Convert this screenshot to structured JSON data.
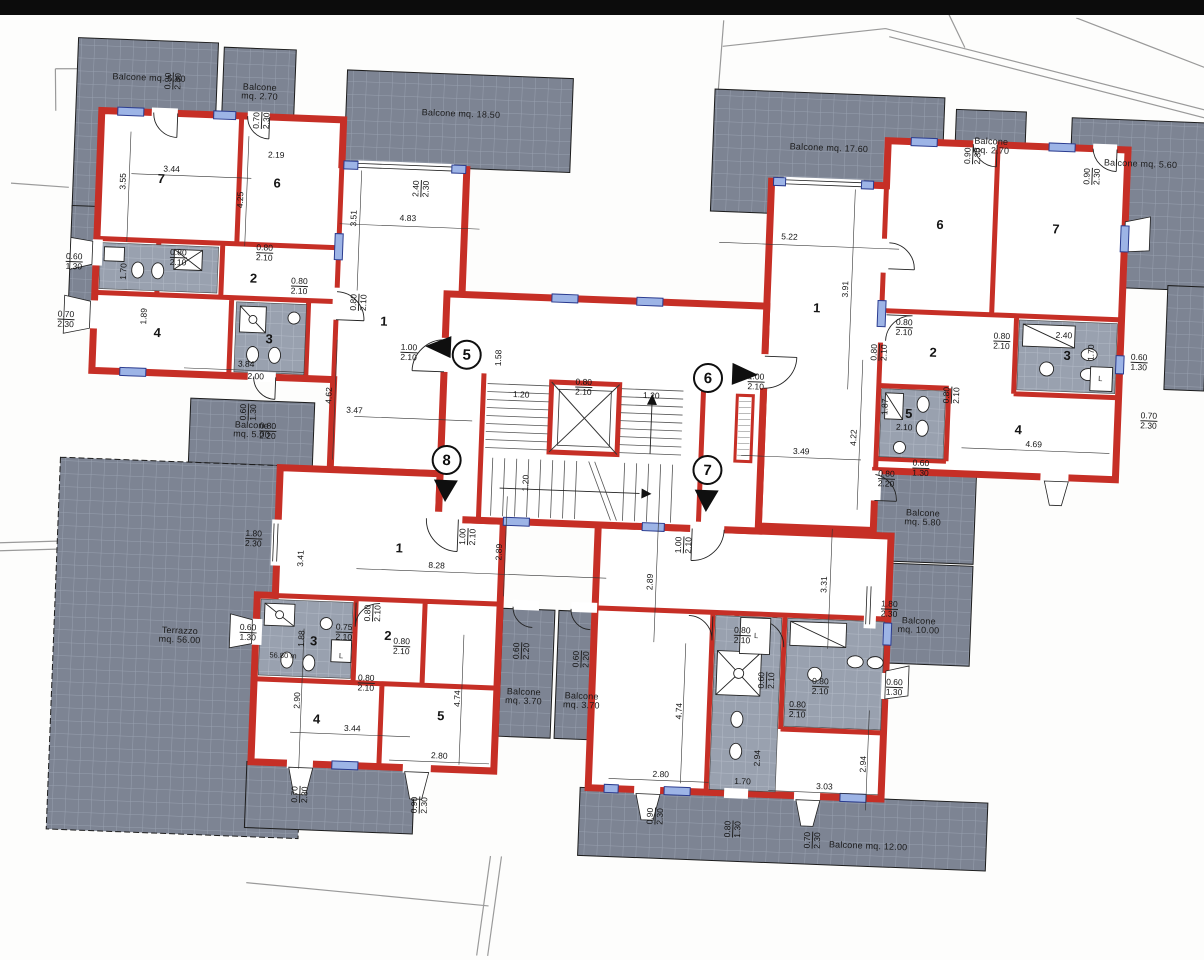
{
  "drawing": {
    "type": "apartment floor plan",
    "colors": {
      "wall": "#c62f26",
      "window": "#9db4e6",
      "balcony_fill": "#7d8493",
      "balcony_grid": "#98a0af",
      "paper": "#ffffff"
    }
  },
  "units": [
    {
      "number": "5",
      "x": 462,
      "y": 360,
      "arrow": "left",
      "ax": 420,
      "ay": 342
    },
    {
      "number": "6",
      "x": 704,
      "y": 374,
      "arrow": "right",
      "ax": 728,
      "ay": 358
    },
    {
      "number": "8",
      "x": 446,
      "y": 466,
      "arrow": "down",
      "ax": 434,
      "ay": 486
    },
    {
      "number": "7",
      "x": 707,
      "y": 466,
      "arrow": "down",
      "ax": 695,
      "ay": 486
    }
  ],
  "labels": [
    {
      "t": "Balcone mq. 5.60",
      "x": 134,
      "y": 96,
      "cls": "area"
    },
    {
      "t": "Balcone\nmq. 2.70",
      "x": 245,
      "y": 106,
      "cls": "area"
    },
    {
      "t": "Balcone mq. 18.50",
      "x": 447,
      "y": 120,
      "cls": "area"
    },
    {
      "t": "Balcone mq. 17.60",
      "x": 816,
      "y": 140,
      "cls": "area"
    },
    {
      "t": "Balcone\nmq. 2.70",
      "x": 978,
      "y": 132,
      "cls": "area"
    },
    {
      "t": "Balcone mq. 5.60",
      "x": 1128,
      "y": 144,
      "cls": "area"
    },
    {
      "t": "Balcone\nmq. 5.00",
      "x": 250,
      "y": 444,
      "cls": "area"
    },
    {
      "t": "Terrazzo\nmq. 56.00",
      "x": 186,
      "y": 652,
      "cls": "area"
    },
    {
      "t": "Balcone\nmq. 5.80",
      "x": 924,
      "y": 506,
      "cls": "area"
    },
    {
      "t": "Balcone\nmq. 10.00",
      "x": 924,
      "y": 614,
      "cls": "area"
    },
    {
      "t": "Balcone\nmq. 3.70",
      "x": 532,
      "y": 700,
      "cls": "area"
    },
    {
      "t": "Balcone\nmq. 3.70",
      "x": 590,
      "y": 702,
      "cls": "area"
    },
    {
      "t": "Balcone mq. 12.00",
      "x": 882,
      "y": 836,
      "cls": "area"
    },
    {
      "t": "7",
      "x": 150,
      "y": 196,
      "cls": "room"
    },
    {
      "t": "6",
      "x": 266,
      "y": 196,
      "cls": "room"
    },
    {
      "t": "2",
      "x": 246,
      "y": 292,
      "cls": "room"
    },
    {
      "t": "4",
      "x": 152,
      "y": 350,
      "cls": "room"
    },
    {
      "t": "3",
      "x": 264,
      "y": 352,
      "cls": "room"
    },
    {
      "t": "1",
      "x": 378,
      "y": 330,
      "cls": "room"
    },
    {
      "t": "6",
      "x": 930,
      "y": 212,
      "cls": "room"
    },
    {
      "t": "7",
      "x": 1046,
      "y": 212,
      "cls": "room"
    },
    {
      "t": "2",
      "x": 928,
      "y": 340,
      "cls": "room"
    },
    {
      "t": "3",
      "x": 1062,
      "y": 338,
      "cls": "room"
    },
    {
      "t": "5",
      "x": 906,
      "y": 402,
      "cls": "room"
    },
    {
      "t": "4",
      "x": 1016,
      "y": 414,
      "cls": "room"
    },
    {
      "t": "1",
      "x": 810,
      "y": 300,
      "cls": "room"
    },
    {
      "t": "1",
      "x": 402,
      "y": 556,
      "cls": "room"
    },
    {
      "t": "3",
      "x": 320,
      "y": 652,
      "cls": "room"
    },
    {
      "t": "2",
      "x": 394,
      "y": 644,
      "cls": "room"
    },
    {
      "t": "4",
      "x": 326,
      "y": 730,
      "cls": "room"
    },
    {
      "t": "5",
      "x": 450,
      "y": 722,
      "cls": "room"
    },
    {
      "t": "3.44",
      "x": 160,
      "y": 186
    },
    {
      "t": "3.55",
      "x": 112,
      "y": 200,
      "v": true
    },
    {
      "t": "2.19",
      "x": 264,
      "y": 168
    },
    {
      "t": "4.25",
      "x": 230,
      "y": 214,
      "v": true
    },
    {
      "t": "0.90\n2.30",
      "x": 158,
      "y": 98,
      "v": true
    },
    {
      "t": "0.70\n2.30",
      "x": 248,
      "y": 134,
      "v": true
    },
    {
      "t": "2.40\n2.30",
      "x": 410,
      "y": 196,
      "v": true
    },
    {
      "t": "4.83",
      "x": 398,
      "y": 226
    },
    {
      "t": "3.51",
      "x": 344,
      "y": 228,
      "v": true
    },
    {
      "t": "0.60\n1.30",
      "x": 66,
      "y": 282
    },
    {
      "t": "1.70",
      "x": 116,
      "y": 290,
      "v": true
    },
    {
      "t": "0.80\n2.10",
      "x": 170,
      "y": 274
    },
    {
      "t": "0.80\n2.10",
      "x": 256,
      "y": 266
    },
    {
      "t": "0.80\n2.10",
      "x": 292,
      "y": 298
    },
    {
      "t": "0.70\n2.30",
      "x": 60,
      "y": 340
    },
    {
      "t": "1.89",
      "x": 138,
      "y": 334,
      "v": true
    },
    {
      "t": "3.84",
      "x": 242,
      "y": 378
    },
    {
      "t": "2.00",
      "x": 252,
      "y": 390
    },
    {
      "t": "0.80\n2.10",
      "x": 352,
      "y": 312,
      "v": true
    },
    {
      "t": "4.62",
      "x": 326,
      "y": 406,
      "v": true
    },
    {
      "t": "3.47",
      "x": 352,
      "y": 420
    },
    {
      "t": "1.00\n2.10",
      "x": 404,
      "y": 360
    },
    {
      "t": "1.58",
      "x": 494,
      "y": 362,
      "v": true
    },
    {
      "t": "0.60\n1.30",
      "x": 246,
      "y": 426,
      "v": true
    },
    {
      "t": "0.80\n2.20",
      "x": 266,
      "y": 444
    },
    {
      "t": "1.80\n2.30",
      "x": 256,
      "y": 552
    },
    {
      "t": "3.41",
      "x": 304,
      "y": 570,
      "v": true
    },
    {
      "t": "1.20",
      "x": 518,
      "y": 398
    },
    {
      "t": "0.80\n2.10",
      "x": 580,
      "y": 388
    },
    {
      "t": "1.20",
      "x": 648,
      "y": 394
    },
    {
      "t": "1.20",
      "x": 526,
      "y": 486,
      "v": true
    },
    {
      "t": "1.00\n2.10",
      "x": 470,
      "y": 542,
      "v": true
    },
    {
      "t": "1.00\n2.10",
      "x": 686,
      "y": 542,
      "v": true
    },
    {
      "t": "8.28",
      "x": 440,
      "y": 572
    },
    {
      "t": "2.89",
      "x": 502,
      "y": 556,
      "v": true
    },
    {
      "t": "2.89",
      "x": 654,
      "y": 580,
      "v": true
    },
    {
      "t": "3.31",
      "x": 828,
      "y": 576,
      "v": true
    },
    {
      "t": "5.22",
      "x": 780,
      "y": 230
    },
    {
      "t": "3.91",
      "x": 838,
      "y": 280,
      "v": true
    },
    {
      "t": "0.90\n2.30",
      "x": 960,
      "y": 142,
      "v": true
    },
    {
      "t": "0.90\n2.30",
      "x": 1080,
      "y": 158,
      "v": true
    },
    {
      "t": "0.80\n2.10",
      "x": 898,
      "y": 316
    },
    {
      "t": "0.80\n2.10",
      "x": 874,
      "y": 342,
      "v": true
    },
    {
      "t": "0.80\n2.10",
      "x": 996,
      "y": 326
    },
    {
      "t": "2.40",
      "x": 1058,
      "y": 318
    },
    {
      "t": "1.70",
      "x": 1086,
      "y": 334,
      "v": true
    },
    {
      "t": "0.60\n1.30",
      "x": 1134,
      "y": 342
    },
    {
      "t": "L",
      "x": 1096,
      "y": 360,
      "cls": "tiny"
    },
    {
      "t": "1.87",
      "x": 882,
      "y": 396,
      "v": true
    },
    {
      "t": "2.10",
      "x": 902,
      "y": 416
    },
    {
      "t": "0.80\n2.10",
      "x": 948,
      "y": 382,
      "v": true
    },
    {
      "t": "4.69",
      "x": 1032,
      "y": 428
    },
    {
      "t": "0.70\n2.30",
      "x": 1146,
      "y": 400
    },
    {
      "t": "0.80\n2.20",
      "x": 886,
      "y": 468
    },
    {
      "t": "0.60\n1.30",
      "x": 920,
      "y": 456
    },
    {
      "t": "1.00\n2.10",
      "x": 752,
      "y": 376
    },
    {
      "t": "3.49",
      "x": 800,
      "y": 444
    },
    {
      "t": "4.22",
      "x": 852,
      "y": 428,
      "v": true
    },
    {
      "t": "1.80\n2.30",
      "x": 894,
      "y": 598
    },
    {
      "t": "0.80\n2.10",
      "x": 378,
      "y": 622,
      "v": true
    },
    {
      "t": "1.88",
      "x": 308,
      "y": 650,
      "v": true
    },
    {
      "t": "0.75\n2.10",
      "x": 350,
      "y": 642
    },
    {
      "t": "0.80\n2.10",
      "x": 408,
      "y": 654
    },
    {
      "t": "0.80\n2.10",
      "x": 374,
      "y": 692
    },
    {
      "t": "56.80 m",
      "x": 290,
      "y": 668,
      "cls": "tiny"
    },
    {
      "t": "0.60\n1.30",
      "x": 254,
      "y": 646
    },
    {
      "t": "L",
      "x": 348,
      "y": 666,
      "cls": "tiny"
    },
    {
      "t": "2.90",
      "x": 306,
      "y": 712,
      "v": true
    },
    {
      "t": "3.44",
      "x": 362,
      "y": 738
    },
    {
      "t": "2.80",
      "x": 450,
      "y": 762
    },
    {
      "t": "4.74",
      "x": 466,
      "y": 704,
      "v": true
    },
    {
      "t": "0.60\n2.20",
      "x": 528,
      "y": 654,
      "v": true
    },
    {
      "t": "0.60\n2.20",
      "x": 588,
      "y": 660,
      "v": true
    },
    {
      "t": "0.70\n2.30",
      "x": 312,
      "y": 806,
      "v": true
    },
    {
      "t": "0.90\n2.30",
      "x": 432,
      "y": 812,
      "v": true
    },
    {
      "t": "0.80\n2.10",
      "x": 748,
      "y": 630
    },
    {
      "t": "L",
      "x": 762,
      "y": 630,
      "cls": "tiny"
    },
    {
      "t": "0.60\n2.10",
      "x": 774,
      "y": 674,
      "v": true
    },
    {
      "t": "0.80\n2.10",
      "x": 828,
      "y": 678
    },
    {
      "t": "0.80\n2.10",
      "x": 806,
      "y": 702
    },
    {
      "t": "4.74",
      "x": 688,
      "y": 708,
      "v": true
    },
    {
      "t": "2.80",
      "x": 672,
      "y": 772
    },
    {
      "t": "2.94",
      "x": 768,
      "y": 752,
      "v": true
    },
    {
      "t": "1.70",
      "x": 754,
      "y": 776
    },
    {
      "t": "2.94",
      "x": 874,
      "y": 754,
      "v": true
    },
    {
      "t": "3.03",
      "x": 836,
      "y": 778
    },
    {
      "t": "0.60\n1.30",
      "x": 902,
      "y": 676
    },
    {
      "t": "0.90\n2.30",
      "x": 668,
      "y": 814,
      "v": true
    },
    {
      "t": "0.80\n1.30",
      "x": 746,
      "y": 824,
      "v": true
    },
    {
      "t": "0.70\n2.30",
      "x": 826,
      "y": 832,
      "v": true
    }
  ]
}
